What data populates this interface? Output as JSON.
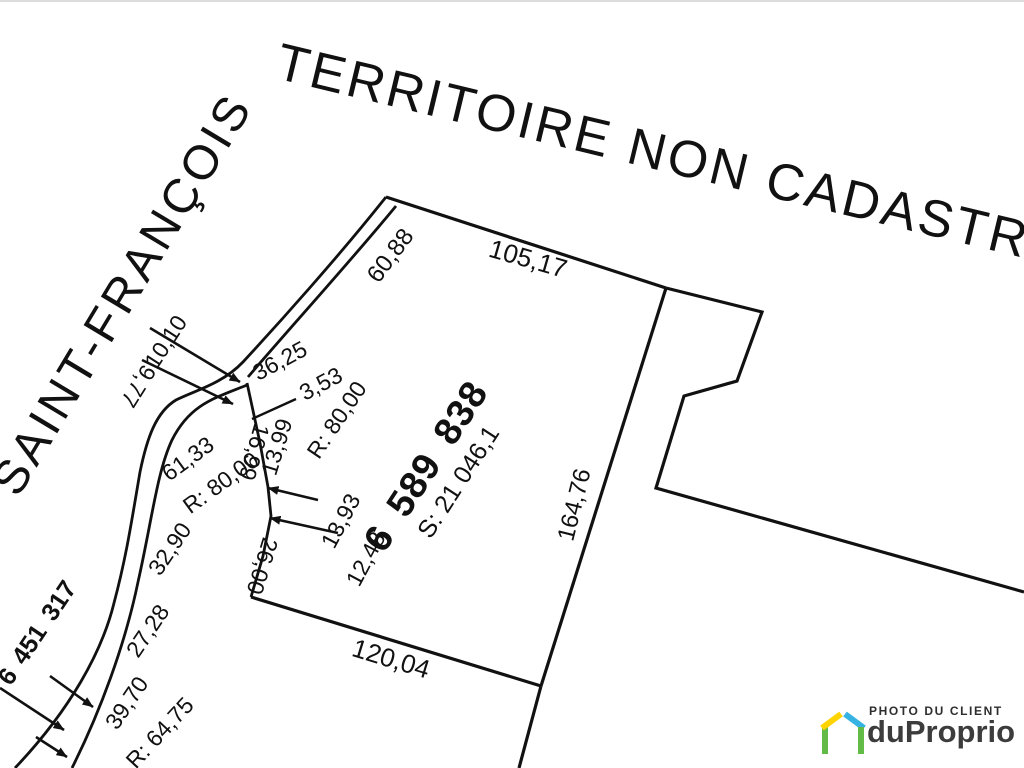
{
  "plan": {
    "title": "TERRITOIRE NON CADASTRÉ",
    "river_name": "SAINT-FRANÇOIS",
    "river_name_partial": "U",
    "main_lot": {
      "number": "6 589 838",
      "area": "S: 21 046,1"
    },
    "adjacent_lot": {
      "number": "6 451 317"
    },
    "measurements": [
      {
        "text": "10,10",
        "x": 166,
        "y": 342,
        "rot": -57,
        "fs": 23
      },
      {
        "text": "9,77",
        "x": 138,
        "y": 386,
        "rot": 122,
        "fs": 23
      },
      {
        "text": "36,25",
        "x": 280,
        "y": 361,
        "rot": -28,
        "fs": 23
      },
      {
        "text": "3,53",
        "x": 321,
        "y": 384,
        "rot": -28,
        "fs": 23
      },
      {
        "text": "R: 80,00",
        "x": 337,
        "y": 420,
        "rot": -56,
        "fs": 23
      },
      {
        "text": "13,99",
        "x": 277,
        "y": 447,
        "rot": -73,
        "fs": 23
      },
      {
        "text": "16,99",
        "x": 254,
        "y": 452,
        "rot": 106,
        "fs": 23
      },
      {
        "text": "13,93",
        "x": 341,
        "y": 521,
        "rot": -62,
        "fs": 23
      },
      {
        "text": "12,48",
        "x": 366,
        "y": 559,
        "rot": -62,
        "fs": 23
      },
      {
        "text": "26,00",
        "x": 262,
        "y": 566,
        "rot": 107,
        "fs": 23
      },
      {
        "text": "61,33",
        "x": 188,
        "y": 459,
        "rot": -36,
        "fs": 23
      },
      {
        "text": "R: 80,00",
        "x": 221,
        "y": 483,
        "rot": -36,
        "fs": 23
      },
      {
        "text": "32,90",
        "x": 170,
        "y": 549,
        "rot": -56,
        "fs": 23
      },
      {
        "text": "27,28",
        "x": 148,
        "y": 631,
        "rot": -56,
        "fs": 23
      },
      {
        "text": "39,70",
        "x": 127,
        "y": 703,
        "rot": -56,
        "fs": 23
      },
      {
        "text": "R: 64,75",
        "x": 160,
        "y": 733,
        "rot": -47,
        "fs": 23
      },
      {
        "text": "60,88",
        "x": 391,
        "y": 256,
        "rot": -53,
        "fs": 24
      },
      {
        "text": "105,17",
        "x": 528,
        "y": 259,
        "rot": 16,
        "fs": 26
      },
      {
        "text": "164,76",
        "x": 575,
        "y": 505,
        "rot": -76,
        "fs": 24
      },
      {
        "text": "120,04",
        "x": 391,
        "y": 659,
        "rot": 17,
        "fs": 26
      }
    ]
  },
  "watermark": {
    "tagline": "PHOTO DU CLIENT",
    "brand": "duProprio",
    "colors": {
      "green": "#62bb46",
      "yellow": "#ffd400",
      "blue": "#36b3e3"
    }
  }
}
